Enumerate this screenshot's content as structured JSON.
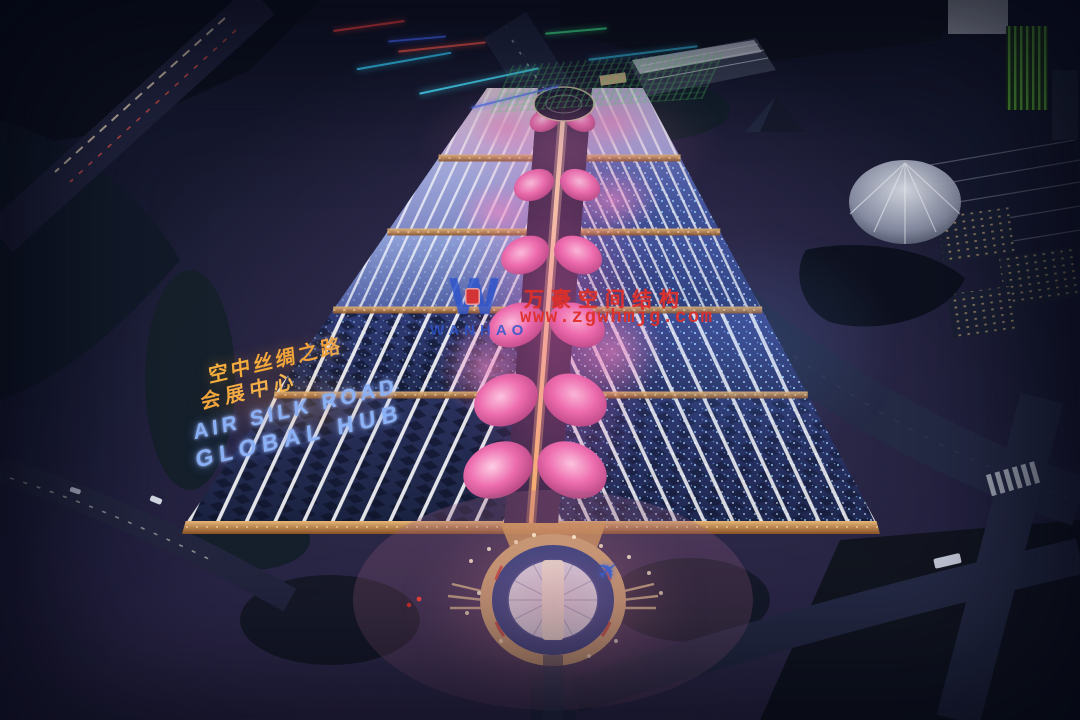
{
  "watermark": {
    "logo_letter": "W",
    "logo_text": "WANHAO",
    "company_name_cn": "万豪空间结构",
    "website": "www.zgwhmjg.com"
  },
  "roof_sign": {
    "line1": "空中丝绸之路",
    "line2": "会展中心",
    "line3": "AIR SILK ROAD",
    "line4": "GLOBAL HUB"
  },
  "icons": {
    "airplane": "✈"
  },
  "colors": {
    "brand_blue": "#2f55cc",
    "brand_red": "#e0302a",
    "roof_text_orange": "#f2a23a",
    "roof_text_blue": "#8ab0f5",
    "petal_pink": "#ee6fb0",
    "roof_navy": "#232a52",
    "sparkle_blue": "#7ec8ff",
    "warm_facade": "#c98a4e"
  }
}
